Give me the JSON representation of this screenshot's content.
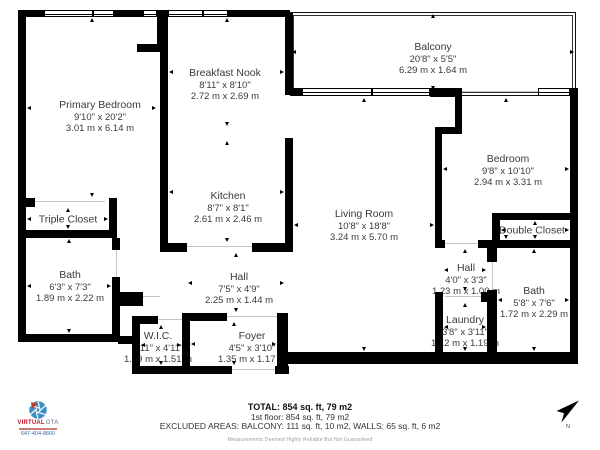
{
  "colors": {
    "wall": "#000000",
    "room_text": "#3a3a3a",
    "logo_red": "#c8102e",
    "logo_blue": "#3a6f9f",
    "disclaimer_gray": "#9a9a9a"
  },
  "floorplan": {
    "rooms": [
      {
        "id": "primary-bedroom",
        "name": "Primary Bedroom",
        "dim_ft": "9'10\" x 20'2\"",
        "dim_m": "3.01 m x 6.14 m",
        "rect": [
          26,
          17,
          131,
          181
        ],
        "label": [
          100,
          117
        ]
      },
      {
        "id": "breakfast-nook",
        "name": "Breakfast Nook",
        "dim_ft": "8'11\" x 8'10\"",
        "dim_m": "2.72 m x 2.69 m",
        "rect": [
          168,
          17,
          117,
          110
        ],
        "label": [
          225,
          85
        ]
      },
      {
        "id": "kitchen",
        "name": "Kitchen",
        "dim_ft": "8'7\" x 8'1\"",
        "dim_m": "2.61 m x 2.46 m",
        "rect": [
          168,
          140,
          117,
          103
        ],
        "label": [
          228,
          208
        ]
      },
      {
        "id": "balcony",
        "name": "Balcony",
        "dim_ft": "20'8\" x 5'5\"",
        "dim_m": "6.29 m x 1.64 m",
        "rect": [
          291,
          13,
          284,
          78
        ],
        "label": [
          433,
          59
        ]
      },
      {
        "id": "bedroom",
        "name": "Bedroom",
        "dim_ft": "9'8\" x 10'10\"",
        "dim_m": "2.94 m x 3.31 m",
        "rect": [
          442,
          97,
          128,
          143
        ],
        "label": [
          508,
          171
        ]
      },
      {
        "id": "living-room",
        "name": "Living Room",
        "dim_ft": "10'8\" x 18'8\"",
        "dim_m": "3.24 m x 5.70 m",
        "rect": [
          293,
          97,
          142,
          255
        ],
        "label": [
          364,
          226
        ]
      },
      {
        "id": "triple-closet",
        "name": "Triple Closet",
        "dim_ft": "",
        "dim_m": "",
        "rect": [
          26,
          207,
          83,
          23
        ],
        "label": [
          68,
          220
        ]
      },
      {
        "id": "bath-1",
        "name": "Bath",
        "dim_ft": "6'3\" x 7'3\"",
        "dim_m": "1.89 m x 2.22 m",
        "rect": [
          26,
          238,
          86,
          96
        ],
        "label": [
          70,
          287
        ]
      },
      {
        "id": "hall-1",
        "name": "Hall",
        "dim_ft": "7'5\" x 4'9\"",
        "dim_m": "2.25 m x 1.44 m",
        "rect": [
          187,
          252,
          98,
          61
        ],
        "label": [
          239,
          289
        ]
      },
      {
        "id": "wic",
        "name": "W.I.C.",
        "dim_ft": "4'11\" x 4'11\"",
        "dim_m": "1.49 m x 1.51 m",
        "rect": [
          140,
          324,
          42,
          42
        ],
        "label": [
          158,
          348
        ]
      },
      {
        "id": "foyer",
        "name": "Foyer",
        "dim_ft": "4'5\" x 3'10\"",
        "dim_m": "1.35 m x 1.17 m",
        "rect": [
          190,
          321,
          87,
          45
        ],
        "label": [
          252,
          348
        ]
      },
      {
        "id": "double-closet",
        "name": "Double Closet",
        "dim_ft": "",
        "dim_m": "",
        "rect": [
          500,
          220,
          70,
          20
        ],
        "label": [
          532,
          231
        ]
      },
      {
        "id": "hall-2",
        "name": "Hall",
        "dim_ft": "4'0\" x 3'3\"",
        "dim_m": "1.23 m x 1.00 m",
        "rect": [
          443,
          248,
          44,
          44
        ],
        "label": [
          466,
          280
        ]
      },
      {
        "id": "laundry",
        "name": "Laundry",
        "dim_ft": "3'8\" x 3'11\"",
        "dim_m": "1.12 m x 1.19 m",
        "rect": [
          443,
          302,
          44,
          50
        ],
        "label": [
          465,
          332
        ]
      },
      {
        "id": "bath-2",
        "name": "Bath",
        "dim_ft": "5'8\" x 7'6\"",
        "dim_m": "1.72 m x 2.29 m",
        "rect": [
          497,
          248,
          73,
          104
        ],
        "label": [
          534,
          303
        ]
      }
    ],
    "walls": [
      [
        18,
        10,
        26,
        7
      ],
      [
        114,
        10,
        29,
        7
      ],
      [
        157,
        10,
        11,
        42
      ],
      [
        137,
        44,
        31,
        8
      ],
      [
        228,
        10,
        62,
        7
      ],
      [
        18,
        10,
        8,
        332
      ],
      [
        160,
        52,
        8,
        200
      ],
      [
        25,
        198,
        10,
        9
      ],
      [
        109,
        198,
        8,
        40
      ],
      [
        18,
        230,
        99,
        8
      ],
      [
        112,
        238,
        8,
        12
      ],
      [
        112,
        277,
        8,
        57
      ],
      [
        18,
        334,
        102,
        8
      ],
      [
        115,
        292,
        28,
        14
      ],
      [
        118,
        336,
        22,
        8
      ],
      [
        132,
        316,
        8,
        58
      ],
      [
        132,
        316,
        26,
        8
      ],
      [
        182,
        313,
        8,
        61
      ],
      [
        182,
        313,
        45,
        8
      ],
      [
        132,
        366,
        100,
        8
      ],
      [
        275,
        366,
        14,
        8
      ],
      [
        277,
        313,
        11,
        60
      ],
      [
        283,
        352,
        295,
        12
      ],
      [
        570,
        88,
        8,
        276
      ],
      [
        163,
        243,
        24,
        9
      ],
      [
        252,
        243,
        41,
        9
      ],
      [
        285,
        13,
        8,
        82
      ],
      [
        285,
        138,
        8,
        109
      ],
      [
        290,
        88,
        12,
        8
      ],
      [
        430,
        88,
        32,
        9
      ],
      [
        455,
        97,
        7,
        37
      ],
      [
        442,
        127,
        20,
        7
      ],
      [
        435,
        127,
        7,
        121
      ],
      [
        478,
        240,
        100,
        8
      ],
      [
        435,
        240,
        10,
        8
      ],
      [
        492,
        213,
        8,
        35
      ],
      [
        492,
        213,
        86,
        7
      ],
      [
        435,
        292,
        8,
        62
      ],
      [
        481,
        292,
        16,
        10
      ],
      [
        487,
        248,
        10,
        14
      ],
      [
        487,
        290,
        10,
        64
      ]
    ],
    "windows": [
      [
        44,
        10,
        70,
        7
      ],
      [
        143,
        10,
        14,
        7
      ],
      [
        168,
        10,
        60,
        7
      ],
      [
        302,
        88,
        128,
        8
      ],
      [
        538,
        88,
        32,
        8
      ]
    ],
    "window_dividers": [
      [
        92,
        10,
        2,
        7
      ],
      [
        202,
        10,
        2,
        7
      ],
      [
        371,
        88,
        2,
        8
      ]
    ],
    "openings": [
      [
        35,
        201,
        70,
        1
      ],
      [
        187,
        246,
        65,
        1
      ],
      [
        462,
        91,
        76,
        1
      ],
      [
        445,
        243,
        33,
        1
      ],
      [
        116,
        250,
        1,
        27
      ],
      [
        492,
        262,
        1,
        28
      ],
      [
        445,
        296,
        36,
        1
      ],
      [
        143,
        296,
        17,
        1
      ],
      [
        158,
        319,
        24,
        1
      ],
      [
        227,
        316,
        50,
        1
      ],
      [
        232,
        369,
        43,
        1
      ]
    ],
    "balcony_outline": [
      290,
      12,
      286,
      84
    ]
  },
  "footer": {
    "total": "TOTAL: 854 sq. ft, 79 m2",
    "floor": "1st floor: 854 sq. ft, 79 m2",
    "excluded": "EXCLUDED AREAS: BALCONY: 111 sq. ft, 10 m2, WALLS: 65 sq. ft, 6 m2",
    "disclaimer": "Measurements Deemed Highly Reliable But Not Guaranteed"
  },
  "logo": {
    "brand_primary": "VIRTUAL",
    "brand_secondary": "GTA",
    "phone": "647-404-8800"
  },
  "compass": {
    "label": "N"
  }
}
